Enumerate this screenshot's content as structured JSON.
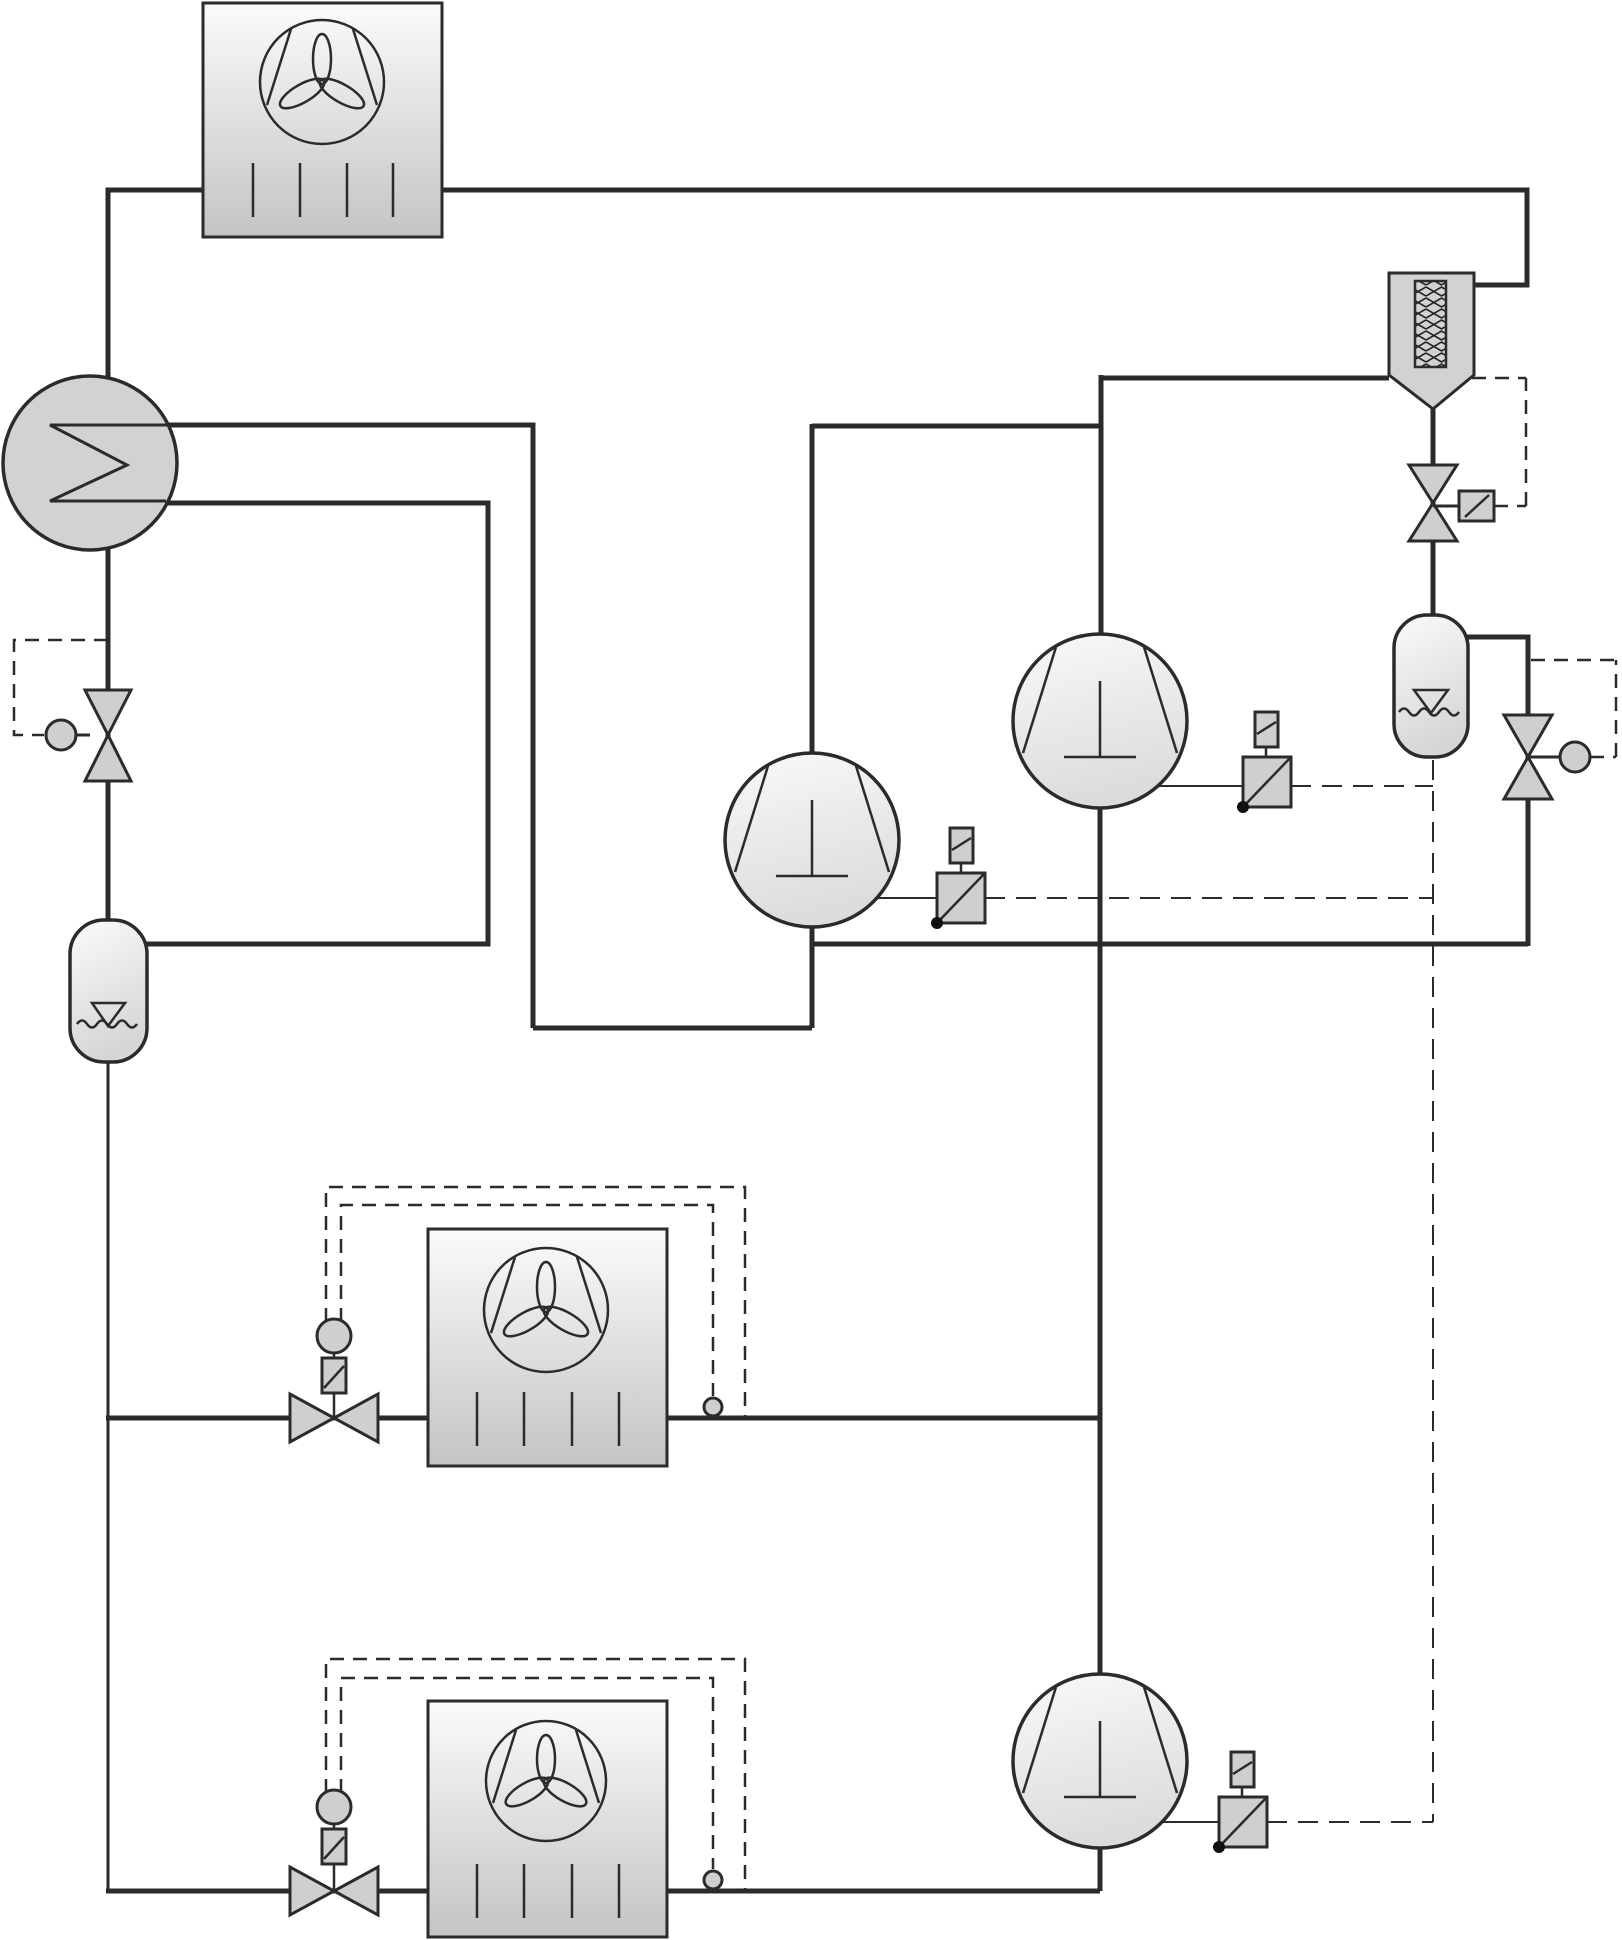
{
  "diagram": {
    "type": "refrigeration-piping-schematic",
    "visible_text": "",
    "colors": {
      "line": "#2b2b2b",
      "component_fill": "#cfcfcf",
      "gradient_light": "#fafafa",
      "gradient_dark": "#c6c6c6",
      "background": "#ffffff"
    },
    "symbols": [
      {
        "id": "condenser-unit",
        "icon": "fan-coil-box",
        "count": 1
      },
      {
        "id": "plate-heat-exchanger",
        "icon": "circle-sigma",
        "count": 1
      },
      {
        "id": "expansion-valve-left",
        "icon": "bowtie-valve-with-bulb",
        "count": 1
      },
      {
        "id": "liquid-receiver-left",
        "icon": "vertical-vessel-level",
        "count": 1
      },
      {
        "id": "compressor",
        "icon": "circle-chords-tee",
        "count": 3
      },
      {
        "id": "oil-level-regulator",
        "icon": "square-diagonal-dot",
        "count": 3
      },
      {
        "id": "oil-separator",
        "icon": "funnel-vessel-coil",
        "count": 1
      },
      {
        "id": "solenoid-drain-valve",
        "icon": "bowtie-valve-coil-box",
        "count": 1
      },
      {
        "id": "oil-receiver-right",
        "icon": "vertical-vessel-level",
        "count": 1
      },
      {
        "id": "expansion-valve-right",
        "icon": "bowtie-valve-with-bulb",
        "count": 1
      },
      {
        "id": "evaporator-unit",
        "icon": "fan-coil-box",
        "count": 2
      },
      {
        "id": "thermostatic-expansion-valve",
        "icon": "bowtie-valve-bulb-element",
        "count": 2
      },
      {
        "id": "remote-bulb-sensor",
        "icon": "small-circle",
        "count": 2
      }
    ],
    "line_styles": {
      "main_pipe": "solid thick",
      "control_line": "short dash",
      "oil_equalizing_line": "long dash"
    }
  }
}
